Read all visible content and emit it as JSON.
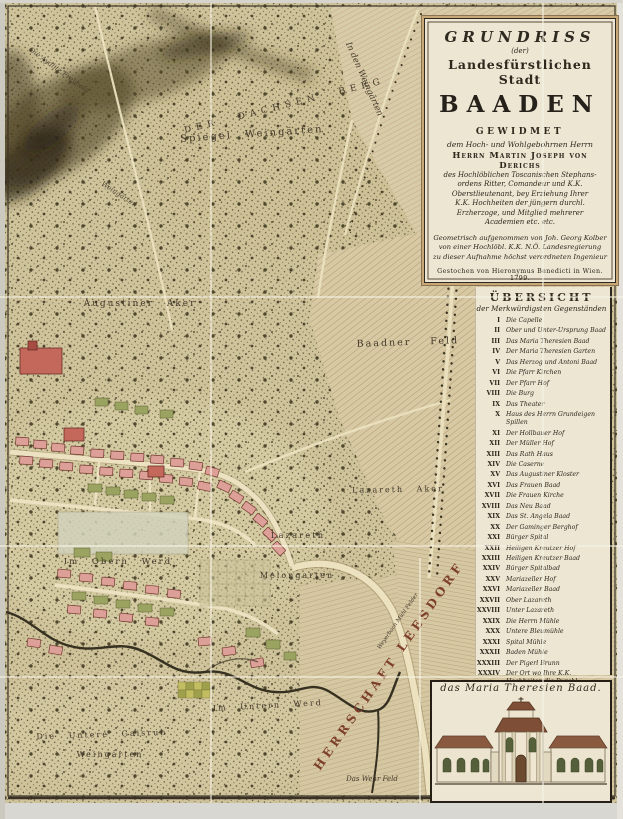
{
  "colors": {
    "parchment": "#cfc39b",
    "field_hatch": "#d6c9a4",
    "panel_paper": "#ece6d3",
    "town_building": "#dda099",
    "town_accent": "#b0544a",
    "garden_green": "#9ba360",
    "river": "#35301f",
    "herrschaft_red": "#7d3f2c",
    "margin_grey": "#d8d7d2"
  },
  "cartouche": {
    "title": "GRUNDRISS",
    "der": "(der)",
    "subtitle": "Landesfürstlichen Stadt",
    "city": "BAADEN",
    "gewidmet": "GEWIDMET",
    "intro": "dem Hoch- und Wohlgebohrnen Herrn",
    "dedicatee": "Herrn Martin Joseph von Derichs",
    "dedication_lines": [
      "des Hochlöblichen Toscanischen Stephans-",
      "ordens Ritter, Comandeur und K.K.",
      "Oberstlieutenant, bey Erziehung Ihrer",
      "K.K. Hochheiten der jüngern durchl.",
      "Erzherzoge, und Mitglied mehrerer",
      "Academien etc. etc."
    ],
    "surveyor_lines": [
      "Geometrisch aufgenommen von Joh. Georg Kolber",
      "von einer Hochlöbl. K.K. N.Ö. Landesregierung",
      "zu dieser Aufnahme höchst verordneten Ingenieur"
    ],
    "engraver": "Gestochen von Hieronymus Benedicti in Wien. 1799."
  },
  "legend": {
    "title": "ÜBERSICHT",
    "subtitle": "der Merkwürdigsten Gegenständen",
    "items": [
      {
        "num": "I",
        "label": "Die Capelle"
      },
      {
        "num": "II",
        "label": "Ober und Unter-Ursprung Baad"
      },
      {
        "num": "III",
        "label": "Das Maria Theresien Baad"
      },
      {
        "num": "IV",
        "label": "Der Maria Theresien Garten"
      },
      {
        "num": "V",
        "label": "Das Herzog und Antoni Baad"
      },
      {
        "num": "VI",
        "label": "Die Pfarr Kirchen"
      },
      {
        "num": "VII",
        "label": "Der Pfarr Hof"
      },
      {
        "num": "VIII",
        "label": "Die Burg"
      },
      {
        "num": "IX",
        "label": "Das Theater"
      },
      {
        "num": "X",
        "label": "Haus des Herrn Grundeigen Spillen"
      },
      {
        "num": "XI",
        "label": "Der Hollbauer Hof"
      },
      {
        "num": "XII",
        "label": "Der Müller Hof"
      },
      {
        "num": "XIII",
        "label": "Das Rath Haus"
      },
      {
        "num": "XIV",
        "label": "Die Caserne"
      },
      {
        "num": "XV",
        "label": "Das Augustiner Kloster"
      },
      {
        "num": "XVI",
        "label": "Das Frauen Baad"
      },
      {
        "num": "XVII",
        "label": "Die Frauen Kirche"
      },
      {
        "num": "XVIII",
        "label": "Das Neu Baad"
      },
      {
        "num": "XIX",
        "label": "Das St. Angela Baad"
      },
      {
        "num": "XX",
        "label": "Der Gaminger Berghof"
      },
      {
        "num": "XXI",
        "label": "Bürger Spital"
      },
      {
        "num": "XXII",
        "label": "Heiligen Kreutzer Hof"
      },
      {
        "num": "XXIII",
        "label": "Heiligen Kreutzer Baad"
      },
      {
        "num": "XXIV",
        "label": "Bürger Spitalbad"
      },
      {
        "num": "XXV",
        "label": "Mariazeller Hof"
      },
      {
        "num": "XXVI",
        "label": "Mariazeller Baad"
      },
      {
        "num": "XXVII",
        "label": "Ober Lazareth"
      },
      {
        "num": "XXVIII",
        "label": "Unter Lazareth"
      },
      {
        "num": "XXIX",
        "label": "Die Herrn Mühle"
      },
      {
        "num": "XXX",
        "label": "Untere Bleumühle"
      },
      {
        "num": "XXXI",
        "label": "Spital Mühle"
      },
      {
        "num": "XXXII",
        "label": "Baden Mühle"
      },
      {
        "num": "XXXIII",
        "label": "Der Pigerl Brunn"
      },
      {
        "num": "XXXIV",
        "label": "Der Ort wo Ihre K.K. Hochheiten die Durchl. Erzherzoginnen Mariana, Clementina und Amalia, den 11 July 1792 mit andern Schnitten Kreuz Schnecken gesetzt haben."
      }
    ]
  },
  "inset": {
    "caption": "das Maria Theresien Baad."
  },
  "map": {
    "labels": {
      "berg": "Der Dachsen Berg",
      "aydlitz": "Die Aydlitz Freyhaid",
      "weingarten_side": "Weingärten",
      "spiegel": "Spiegel Weingärten",
      "in_den_weingaerten": "In den Weingärten",
      "augustiner": "Augustiner Aker",
      "baadner_feld": "Baadner Feld",
      "lazareth_aker": "Lazareth Aker",
      "lazareth": "Lazareth",
      "melongarten": "Melongarten",
      "obern_werd": "Im Obern Werd",
      "untern_werd": "Im Untern Werd",
      "gaisruh_1": "Die Untere Gaisruh",
      "gaisruh_2": "Weingarten",
      "wehr_feld": "Das Wehr Feld",
      "herrschaft": "HERRSCHAFT LEESDORF",
      "weyerbach": "Weyerbach Mühl Felder"
    }
  }
}
